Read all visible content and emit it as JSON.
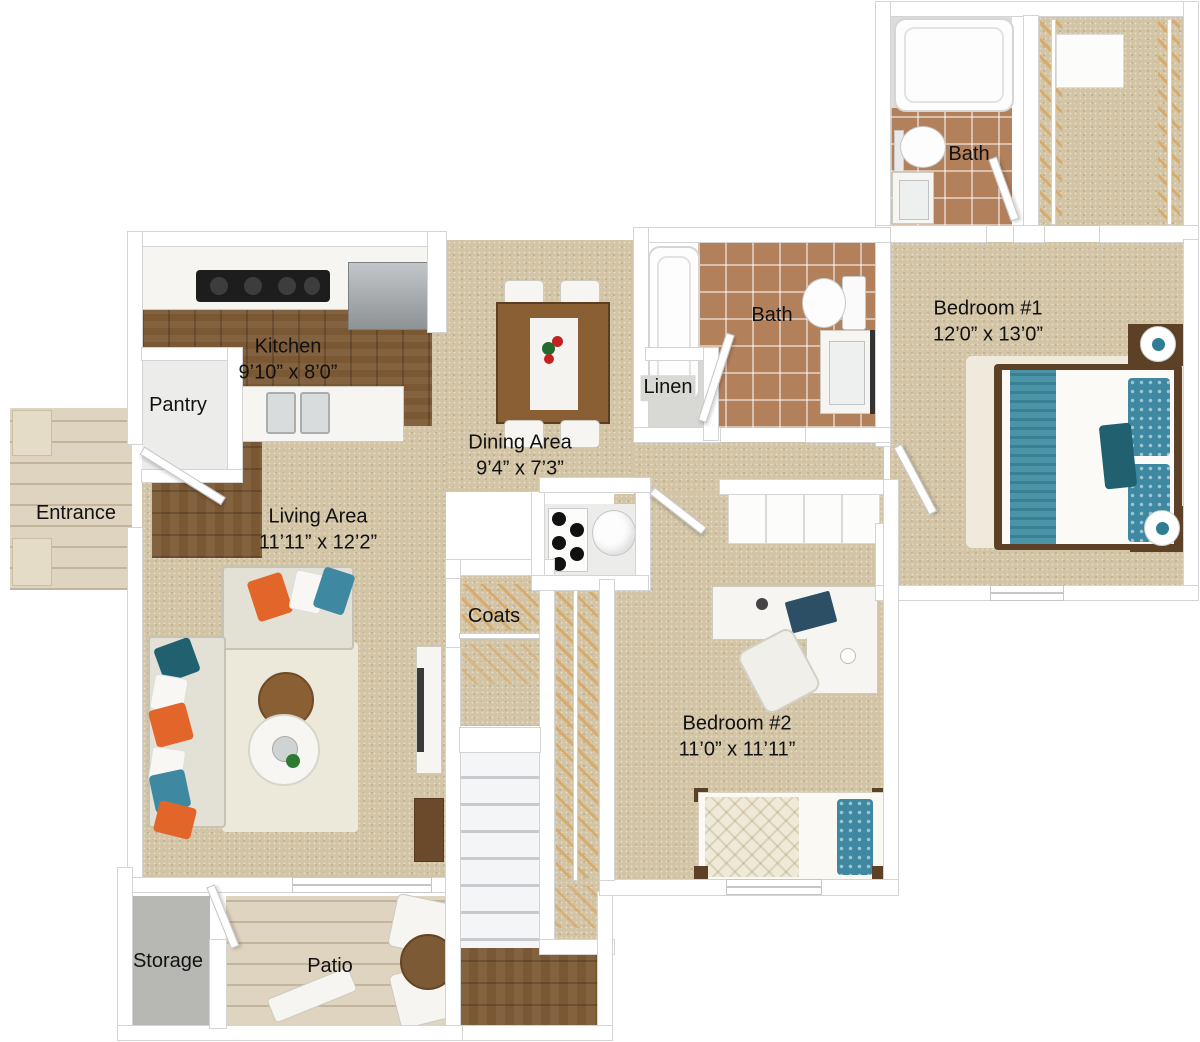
{
  "rooms": {
    "kitchen": {
      "label": "Kitchen",
      "dims": "9’10” x 8’0”"
    },
    "pantry": {
      "label": "Pantry"
    },
    "entrance": {
      "label": "Entrance"
    },
    "dining": {
      "label": "Dining Area",
      "dims": "9’4” x 7’3”"
    },
    "living": {
      "label": "Living Area",
      "dims": "11’11” x 12’2”"
    },
    "coats": {
      "label": "Coats"
    },
    "linen": {
      "label": "Linen"
    },
    "bath_hall": {
      "label": "Bath"
    },
    "bath_master": {
      "label": "Bath"
    },
    "bedroom1": {
      "label": "Bedroom #1",
      "dims": "12’0” x 13’0”"
    },
    "bedroom2": {
      "label": "Bedroom #2",
      "dims": "11’0” x 11’11”"
    },
    "storage": {
      "label": "Storage"
    },
    "patio": {
      "label": "Patio"
    }
  },
  "colors": {
    "carpet": "#d2c4a4",
    "wood_dark": "#7b5834",
    "wood_light": "#ded4bf",
    "tile": "#b3805c",
    "wall": "#ffffff",
    "wall_edge": "#d4d4d4",
    "storage_floor": "#b7b8b4",
    "teal": "#3f88a2",
    "teal_dark": "#20606f",
    "orange": "#e2662a",
    "bed_frame": "#5c4126",
    "table_wood": "#8a5f33",
    "hanger": "#d8a866",
    "label_text": "#111111"
  }
}
